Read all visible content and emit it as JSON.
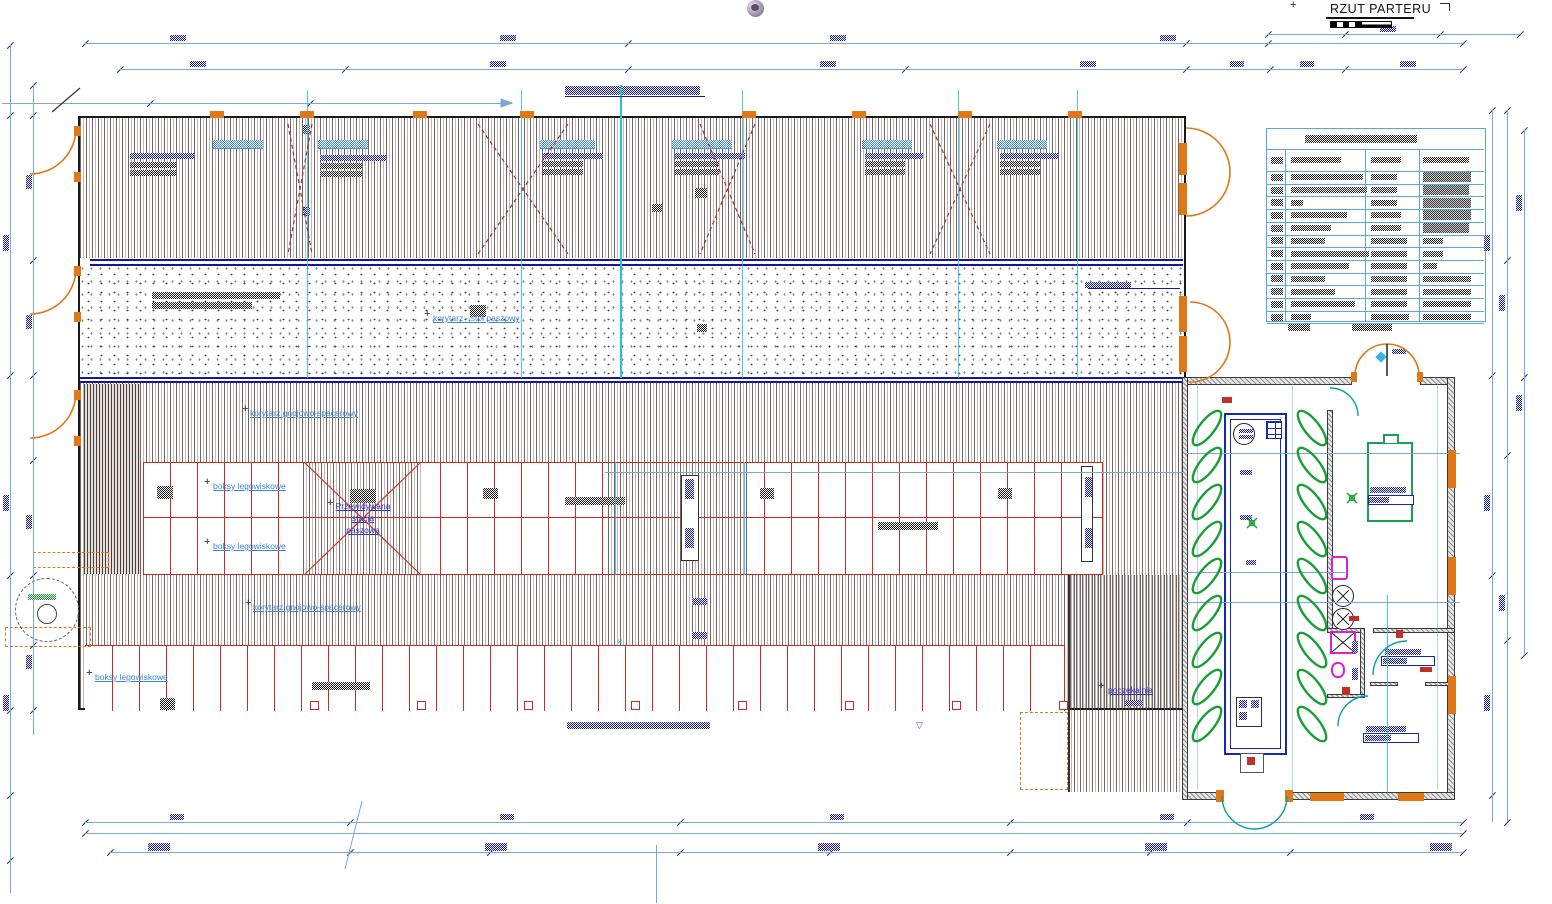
{
  "title": "RZUT PARTERU",
  "plan_labels": {
    "feed_corridor": "korytarz - stół paszowy",
    "cubicle_row_upper": "boksy legowiskowe",
    "cubicle_row_mid": "boksy legowiskowe",
    "cubicle_row_lower": "boksy legowiskowe",
    "walk_corridor_upper": "korytarz gnojowo-spacerowy",
    "walk_corridor_lower": "korytarz gnojowo-spacerowy",
    "feed_station_line1": "Przewidywana",
    "feed_station_line2": "stacja",
    "feed_station_line3": "paszowa",
    "waiting_area": "poczekalnia"
  },
  "icons": {
    "nav_sphere": "navigation-sphere-icon"
  },
  "colors": {
    "dim_line": "#7aa7d9",
    "hatch": "#5c4842",
    "stall_red": "#cc2a22",
    "cad_navy": "#16169a",
    "label_blue": "#3d86d8",
    "label_indigo": "#3232c0",
    "door_orange": "#e07818",
    "door_teal": "#00a8a8",
    "axis_cyan": "#2cc0d8",
    "parlor_green": "#18a035",
    "fixture_magenta": "#e020d0",
    "wall_gray": "#8e8e8e",
    "table_blue": "#58a8d8"
  },
  "legend_table": {
    "note": "room schedule table - text illegible at source resolution",
    "title_bar_width": 112,
    "rows": [
      {
        "c2": 50,
        "c3": 30,
        "c4": 46,
        "dense": 0
      },
      {
        "c2": 72,
        "c3": 26,
        "c4": 48,
        "dense": 1
      },
      {
        "c2": 76,
        "c3": 26,
        "c4": 46,
        "dense": 1
      },
      {
        "c2": 12,
        "c3": 26,
        "c4": 48,
        "dense": 1
      },
      {
        "c2": 56,
        "c3": 30,
        "c4": 48,
        "dense": 1
      },
      {
        "c2": 40,
        "c3": 30,
        "c4": 46,
        "dense": 1
      },
      {
        "c2": 34,
        "c3": 36,
        "c4": 20,
        "dense": 0
      },
      {
        "c2": 78,
        "c3": 36,
        "c4": 20,
        "dense": 0
      },
      {
        "c2": 58,
        "c3": 36,
        "c4": 14,
        "dense": 0
      },
      {
        "c2": 34,
        "c3": 36,
        "c4": 48,
        "dense": 0
      },
      {
        "c2": 44,
        "c3": 36,
        "c4": 48,
        "dense": 0
      },
      {
        "c2": 64,
        "c3": 36,
        "c4": 48,
        "dense": 0
      },
      {
        "c2": 20,
        "c3": 38,
        "c4": 48,
        "dense": 0
      }
    ]
  }
}
